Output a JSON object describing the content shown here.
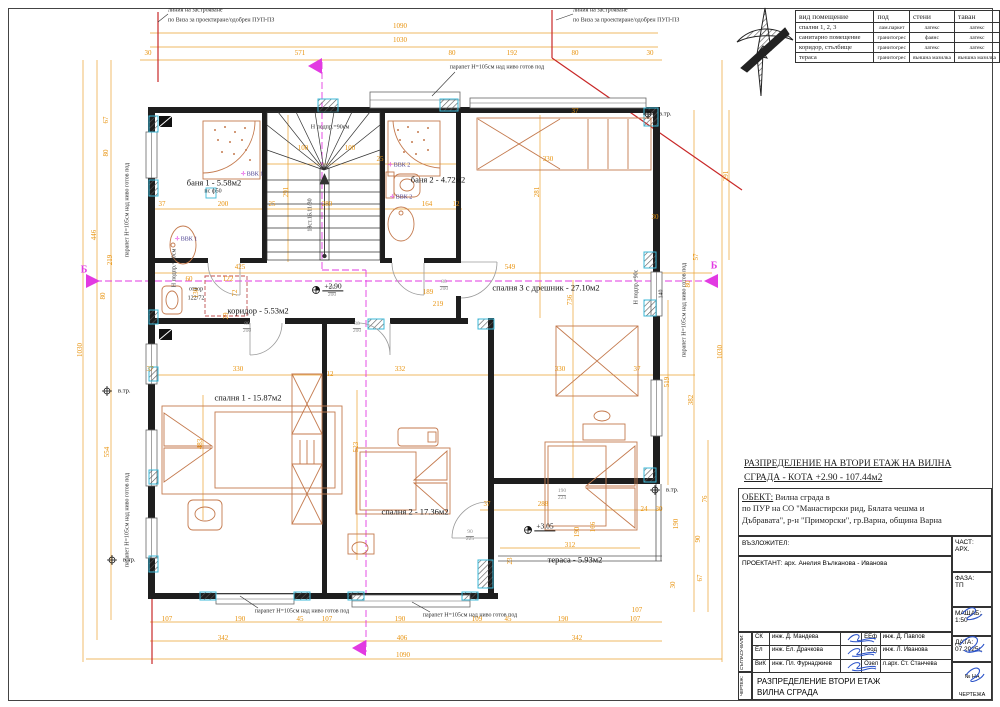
{
  "sheet": {
    "type": "architectural floor plan",
    "language": "bg"
  },
  "finish_table": {
    "headers": [
      "вид помещение",
      "под",
      "стени",
      "таван"
    ],
    "rows": [
      {
        "name": "спални 1, 2, 3",
        "floor": "лам.паркет",
        "walls": "латекс",
        "ceiling": "латекс"
      },
      {
        "name": "санитарно помещение",
        "floor": "гранитогрес",
        "walls": "фаянс",
        "ceiling": "латекс"
      },
      {
        "name": "коридор, стълбище",
        "floor": "гранитогрес",
        "walls": "латекс",
        "ceiling": "латекс"
      },
      {
        "name": "тераса",
        "floor": "гранитогрес",
        "walls": "външна мазилка",
        "ceiling": "външна мазилка"
      }
    ]
  },
  "title_block": {
    "drawing_title_line1": "РАЗПРЕДЕЛЕНИЕ НА ВТОРИ ЕТАЖ НА ВИЛНА",
    "drawing_title_line2": "СГРАДА - КОТА +2.90 - 107.44м2",
    "object_label": "ОБЕКТ:",
    "object_line1": "Вилна сграда в",
    "object_line2": "по ПУР на СО \"Манастирски рид, Бялата чешма и",
    "object_line3": "Дъбравата\", р-н \"Приморски\", гр.Варна, община Варна",
    "client_label": "ВЪЗЛОЖИТЕЛ:",
    "designer_label": "ПРОЕКТАНТ:",
    "designer_name": "арх. Анелия Вълканова - Иванова",
    "part_label": "ЧАСТ:",
    "part_value": "АРХ.",
    "phase_label": "ФАЗА:",
    "phase_value": "ТП",
    "scale_label": "МАЩАБ:",
    "scale_value": "1:50",
    "date_label": "ДАТА:",
    "date_value": "07.2025г.",
    "signers_left": [
      {
        "code": "СК",
        "name": "инж. Д. Мандева"
      },
      {
        "code": "Ел",
        "name": "инж. Ел. Драчкова"
      },
      {
        "code": "ВиК",
        "name": "инж. Пл. Фурнаджиев"
      }
    ],
    "signers_right": [
      {
        "code": "ЕЕф",
        "name": "инж. Д. Павлов"
      },
      {
        "code": "Геод",
        "name": "инж. Л. Иванова"
      },
      {
        "code": "Озел",
        "name": "л.арх. Ст. Станчева"
      }
    ],
    "side_agree": "СЪГЛАСУ-ВАЛИ:",
    "side_drawing": "ЧЕРТЕЖ:",
    "bottom_title_line1": "РАЗПРЕДЕЛЕНИЕ ВТОРИ ЕТАЖ",
    "bottom_title_line2": "ВИЛНА СГРАДА",
    "sheet_label": "№ НА ЧЕРТЕЖА",
    "sheet_value": "3/10"
  },
  "plan": {
    "rooms": [
      [
        "баня 1 - 5.58м2",
        214,
        183
      ],
      [
        "баня 2 - 4.72м2",
        438,
        180
      ],
      [
        "коридор - 5.53м2",
        258,
        311
      ],
      [
        "спалня 3 с дрешник - 27.10м2",
        546,
        288
      ],
      [
        "спалня 1 - 15.87м2",
        248,
        398
      ],
      [
        "спалня 2 - 17.36м2",
        415,
        512
      ],
      [
        "тераса - 5.93м2",
        575,
        560
      ]
    ],
    "notes": [
      [
        "линия на застрояване",
        168,
        11,
        "l"
      ],
      [
        "по Виза за проектиране/одобрен ПУП-ПЗ",
        168,
        21,
        "l"
      ],
      [
        "линия на застрояване",
        573,
        11,
        "l"
      ],
      [
        "по Виза за проектиране/одобрен ПУП-ПЗ",
        573,
        21,
        "l"
      ],
      [
        "парапет H=105см над ниво готов под",
        497,
        68,
        ""
      ],
      [
        "парапет H=105см над ниво готов под",
        302,
        612,
        ""
      ],
      [
        "парапет H=105см над ниво готов под",
        470,
        616,
        ""
      ],
      [
        "парапет H=105см над ниво готов под",
        128,
        210,
        "v"
      ],
      [
        "парапет H=105см над ниво готов под",
        128,
        520,
        "v"
      ],
      [
        "парапет H=105см над ниво готов под",
        685,
        310,
        "v"
      ],
      [
        "Н подпр.=90см",
        330,
        128,
        ""
      ],
      [
        "Н подпр.=90см",
        175,
        268,
        "v"
      ],
      [
        "Н подпр.=90с",
        637,
        287,
        "v"
      ],
      [
        "18ст.16.11/30",
        311,
        215,
        "v"
      ],
      [
        "отвор",
        196,
        290,
        ""
      ],
      [
        "122/72",
        196,
        299,
        ""
      ],
      [
        "пс ф50",
        213,
        192,
        ""
      ],
      [
        "140",
        662,
        294,
        "v"
      ]
    ],
    "vvk": [
      [
        "ВВК 1",
        252,
        175
      ],
      [
        "ВВК 1",
        186,
        240
      ],
      [
        "ВВК 2",
        399,
        166
      ],
      [
        "ВВК 2",
        401,
        198
      ]
    ],
    "vtr": [
      [
        118,
        391
      ],
      [
        659,
        114
      ],
      [
        666,
        490
      ],
      [
        123,
        560
      ]
    ],
    "vtr_label": "в.тр.",
    "section_marks": [
      [
        84,
        270
      ],
      [
        714,
        266
      ]
    ],
    "section_label": "Б",
    "levels": [
      [
        "+2.90",
        333,
        287
      ],
      [
        "+3.05",
        545,
        527
      ]
    ],
    "doors": [
      [
        "80",
        "200",
        247,
        328
      ],
      [
        "80",
        "200",
        357,
        328
      ],
      [
        "80",
        "200",
        444,
        286
      ],
      [
        "90",
        "225",
        470,
        536
      ],
      [
        "190",
        "224",
        562,
        495
      ],
      [
        "90",
        "200",
        332,
        292
      ]
    ],
    "dims": [
      [
        "1090",
        400,
        27,
        0
      ],
      [
        "1030",
        400,
        41,
        0
      ],
      [
        "30",
        148,
        54,
        0
      ],
      [
        "571",
        300,
        54,
        0
      ],
      [
        "80",
        452,
        54,
        0
      ],
      [
        "192",
        512,
        54,
        0
      ],
      [
        "80",
        575,
        54,
        0
      ],
      [
        "30",
        650,
        54,
        0
      ],
      [
        "67",
        107,
        120,
        1
      ],
      [
        "80",
        107,
        153,
        1
      ],
      [
        "446",
        95,
        235,
        1
      ],
      [
        "219",
        111,
        260,
        1
      ],
      [
        "80",
        104,
        296,
        1
      ],
      [
        "554",
        108,
        452,
        1
      ],
      [
        "1030",
        81,
        350,
        1
      ],
      [
        "291",
        727,
        176,
        1
      ],
      [
        "57",
        697,
        257,
        1
      ],
      [
        "80",
        689,
        284,
        1
      ],
      [
        "30",
        655,
        218,
        0
      ],
      [
        "1030",
        721,
        352,
        1
      ],
      [
        "382",
        692,
        400,
        1
      ],
      [
        "519",
        668,
        382,
        1
      ],
      [
        "76",
        706,
        499,
        1
      ],
      [
        "190",
        677,
        524,
        1
      ],
      [
        "90",
        699,
        539,
        1
      ],
      [
        "67",
        701,
        578,
        1
      ],
      [
        "30",
        674,
        585,
        1
      ],
      [
        "24",
        644,
        510,
        0
      ],
      [
        "30",
        659,
        510,
        0
      ],
      [
        "107",
        637,
        611,
        0
      ],
      [
        "37",
        162,
        205,
        0
      ],
      [
        "200",
        223,
        205,
        0
      ],
      [
        "25",
        272,
        205,
        0
      ],
      [
        "280",
        327,
        205,
        0
      ],
      [
        "291",
        287,
        192,
        1
      ],
      [
        "100",
        303,
        149,
        0
      ],
      [
        "100",
        350,
        149,
        0
      ],
      [
        "25",
        380,
        160,
        0
      ],
      [
        "164",
        427,
        205,
        0
      ],
      [
        "12",
        456,
        205,
        0
      ],
      [
        "330",
        548,
        160,
        0
      ],
      [
        "281",
        538,
        192,
        1
      ],
      [
        "37",
        575,
        112,
        0
      ],
      [
        "425",
        240,
        268,
        0
      ],
      [
        "60",
        189,
        280,
        0
      ],
      [
        "122",
        228,
        280,
        0
      ],
      [
        "130",
        197,
        293,
        1
      ],
      [
        "72",
        236,
        293,
        1
      ],
      [
        "29",
        227,
        316,
        1
      ],
      [
        "549",
        510,
        268,
        0
      ],
      [
        "189",
        428,
        293,
        0
      ],
      [
        "219",
        438,
        305,
        0
      ],
      [
        "330",
        238,
        370,
        0
      ],
      [
        "12",
        330,
        375,
        0
      ],
      [
        "332",
        400,
        370,
        0
      ],
      [
        "330",
        560,
        370,
        0
      ],
      [
        "37",
        637,
        370,
        0
      ],
      [
        "37",
        150,
        370,
        0
      ],
      [
        "483",
        201,
        444,
        1
      ],
      [
        "523",
        357,
        447,
        1
      ],
      [
        "736",
        571,
        300,
        1
      ],
      [
        "37",
        487,
        505,
        0
      ],
      [
        "288",
        543,
        505,
        0
      ],
      [
        "312",
        570,
        546,
        0
      ],
      [
        "190",
        578,
        532,
        1
      ],
      [
        "166",
        594,
        527,
        1
      ],
      [
        "23",
        511,
        561,
        1
      ],
      [
        "107",
        167,
        620,
        0
      ],
      [
        "190",
        240,
        620,
        0
      ],
      [
        "45",
        300,
        620,
        0
      ],
      [
        "107",
        327,
        620,
        0
      ],
      [
        "190",
        400,
        620,
        0
      ],
      [
        "109",
        477,
        620,
        0
      ],
      [
        "45",
        508,
        620,
        0
      ],
      [
        "190",
        563,
        620,
        0
      ],
      [
        "107",
        635,
        620,
        0
      ],
      [
        "342",
        223,
        639,
        0
      ],
      [
        "406",
        402,
        639,
        0
      ],
      [
        "342",
        577,
        639,
        0
      ],
      [
        "1090",
        403,
        656,
        0
      ]
    ]
  },
  "colors": {
    "dimension": "#e8920c",
    "axis_magenta": "#e23ae2",
    "building_line_red": "#c82828",
    "pier_cyan": "#3bb8d8",
    "furniture": "#c47a4e",
    "signature_blue": "#2a52c8"
  }
}
